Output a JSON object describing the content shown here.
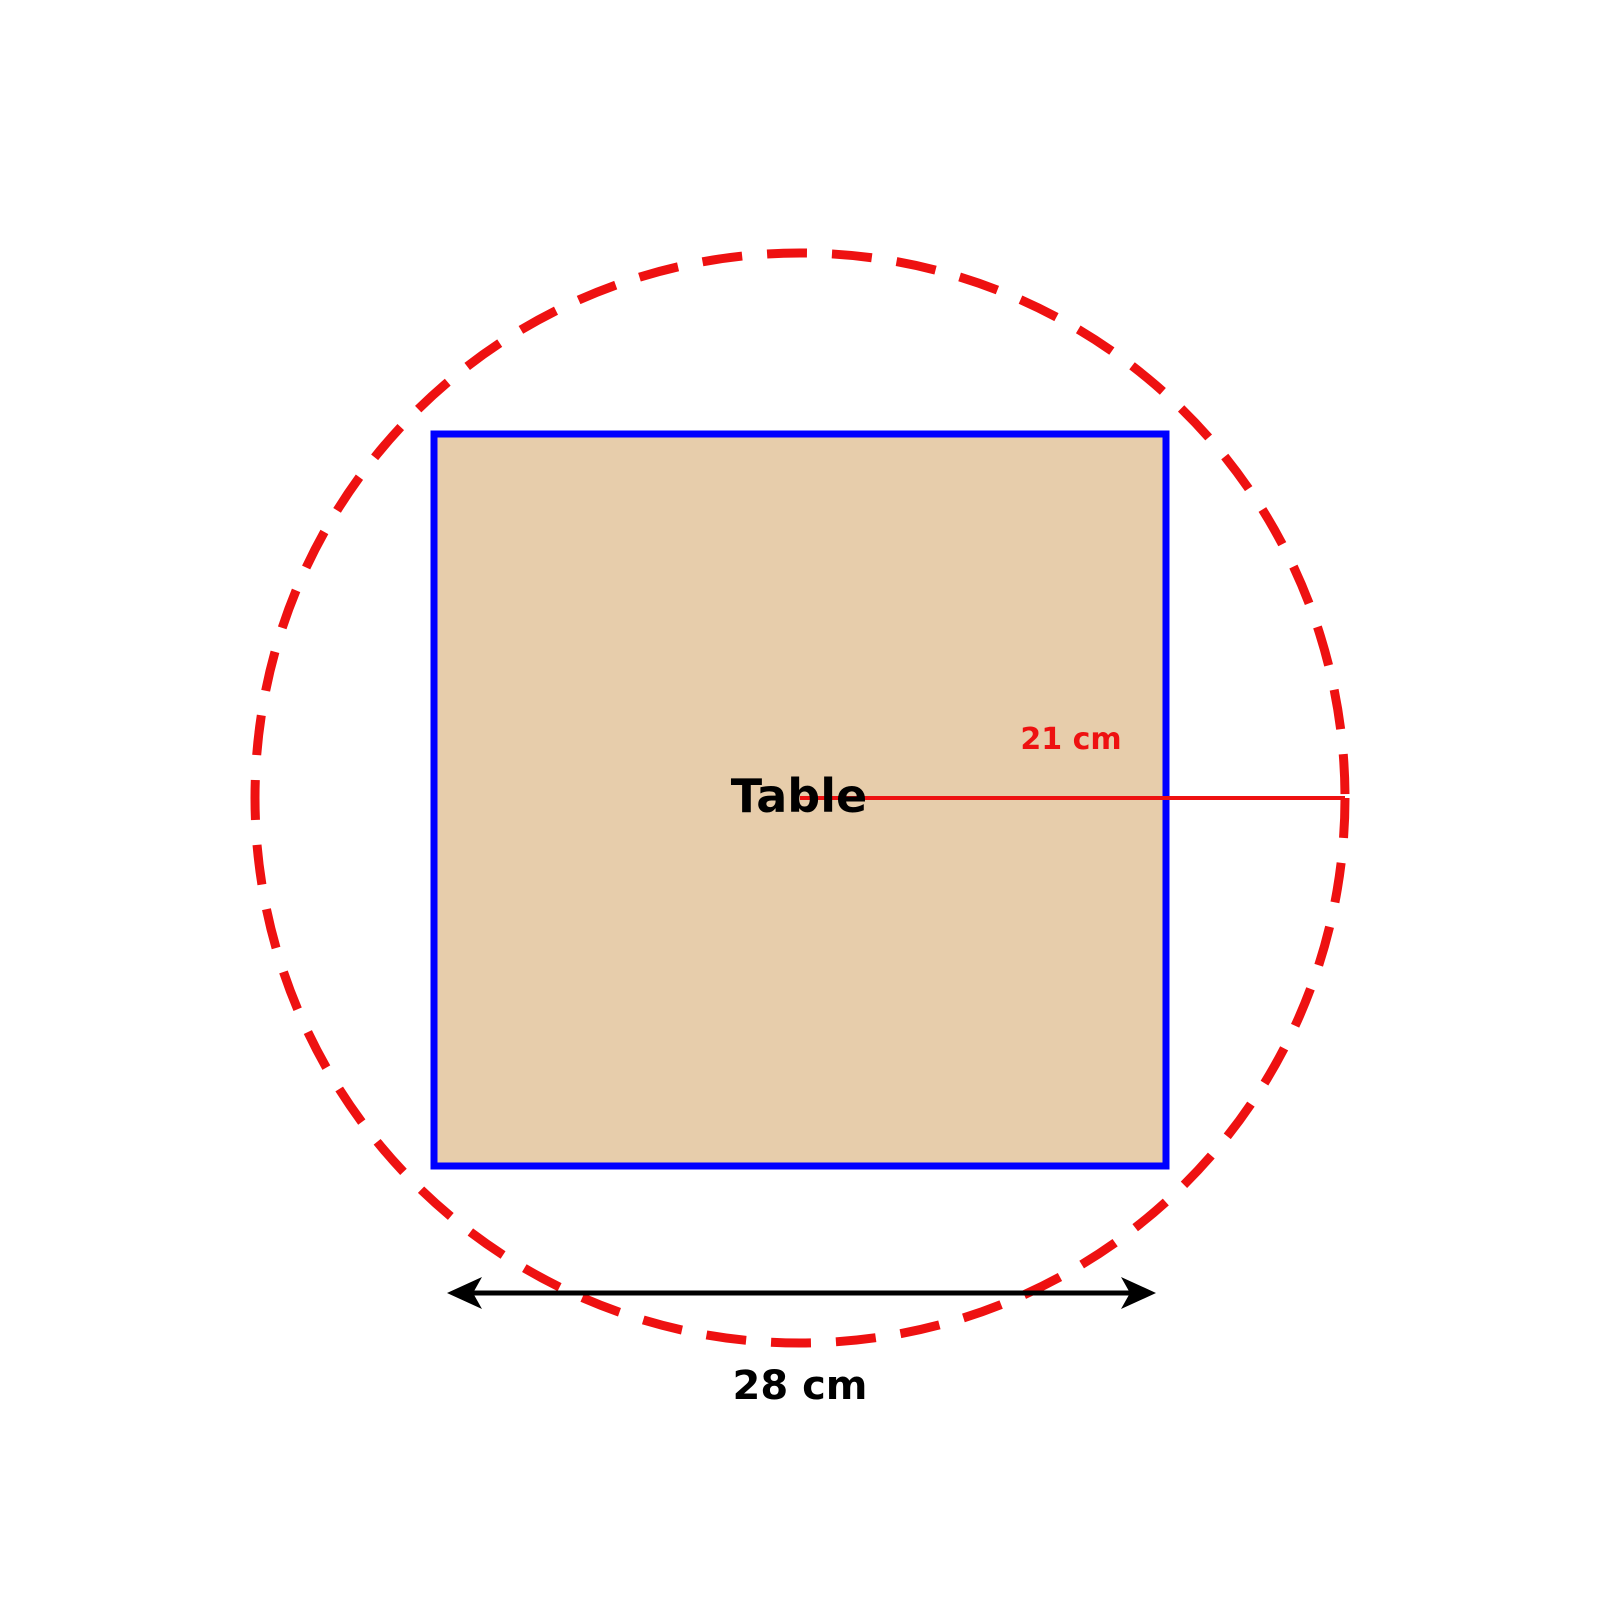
{
  "figure": {
    "table_label": "Table",
    "radius_label": "21 cm",
    "width_label": "28 cm",
    "colors": {
      "background": "#FFFFFF",
      "circle_red": "#EE1111",
      "square_border_blue": "#0000FF",
      "square_fill_tan": "#E7CDAB",
      "radius_line_red": "#EE1111",
      "radius_label_red": "#EE1111",
      "arrow_black": "#000000",
      "label_black": "#000000"
    }
  }
}
